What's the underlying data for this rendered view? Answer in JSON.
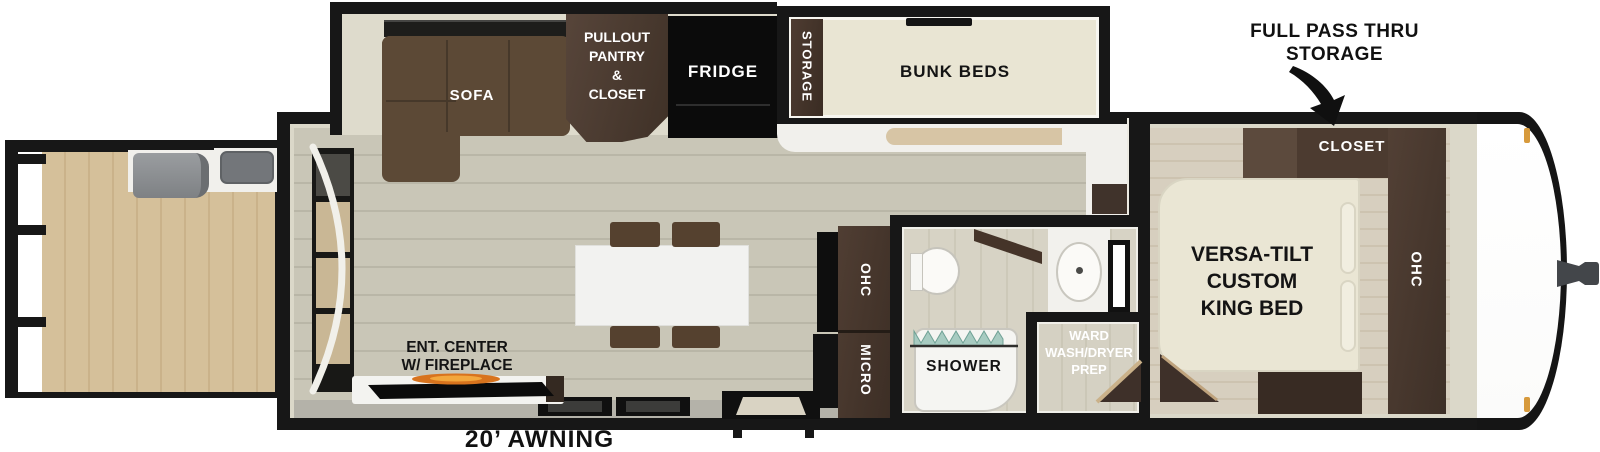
{
  "annotations": {
    "pass_thru": {
      "line1": "FULL PASS THRU",
      "line2": "STORAGE"
    },
    "awning": "20’ AWNING"
  },
  "slideout": {
    "sofa": "SOFA",
    "pantry": {
      "line1": "PULLOUT",
      "line2": "PANTRY",
      "line3": "&",
      "line4": "CLOSET"
    },
    "fridge": "FRIDGE",
    "bunks": {
      "label": "BUNK BEDS",
      "storage": "STORAGE"
    }
  },
  "kitchen": {
    "ohc": "OHC",
    "micro": "MICRO"
  },
  "living": {
    "ent_center": {
      "line1": "ENT. CENTER",
      "line2": "W/ FIREPLACE"
    }
  },
  "bath": {
    "shower": "SHOWER",
    "ward": {
      "line1": "WARD",
      "line2": "WASH/DRYER",
      "line3": "PREP"
    }
  },
  "bedroom": {
    "bed": {
      "line1": "VERSA-TILT",
      "line2": "CUSTOM",
      "line3": "KING BED"
    },
    "closet": "CLOSET",
    "ohc": "OHC"
  },
  "colors": {
    "wall": "#171717",
    "cabinet_brown": "#4a3a30",
    "sofa_brown": "#5c4936",
    "bed_cream": "#eae6d4",
    "floor_living": "#c9c6b7",
    "floor_deck": "#d5c09a",
    "floor_bedroom": "#d7cfbf",
    "flame_orange": "#e07b1f",
    "marker_light": "#d79a3c",
    "curtain_teal": "#a7cbc1"
  }
}
